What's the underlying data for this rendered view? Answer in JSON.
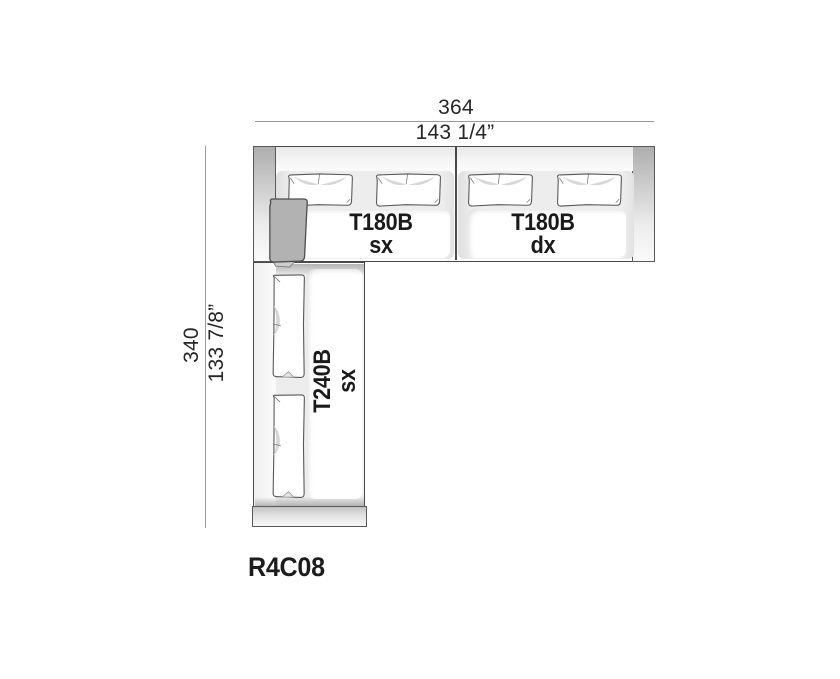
{
  "product_code": "R4C08",
  "dimensions": {
    "width_cm": "364",
    "width_in": "143 1/4”",
    "height_cm": "340",
    "height_in": "133 7/8”"
  },
  "modules": {
    "top_left": {
      "name": "T180B",
      "variant": "sx"
    },
    "top_right": {
      "name": "T180B",
      "variant": "dx"
    },
    "left": {
      "name": "T240B",
      "variant": "sx"
    }
  },
  "colors": {
    "outline": "#4a4a4a",
    "module_bg": "#ededed",
    "armrest_gray": "#b3b3b3",
    "corner_cushion": "#b2b2b2",
    "dimension_line": "#9a9a9a",
    "text": "#1d1d1b"
  }
}
